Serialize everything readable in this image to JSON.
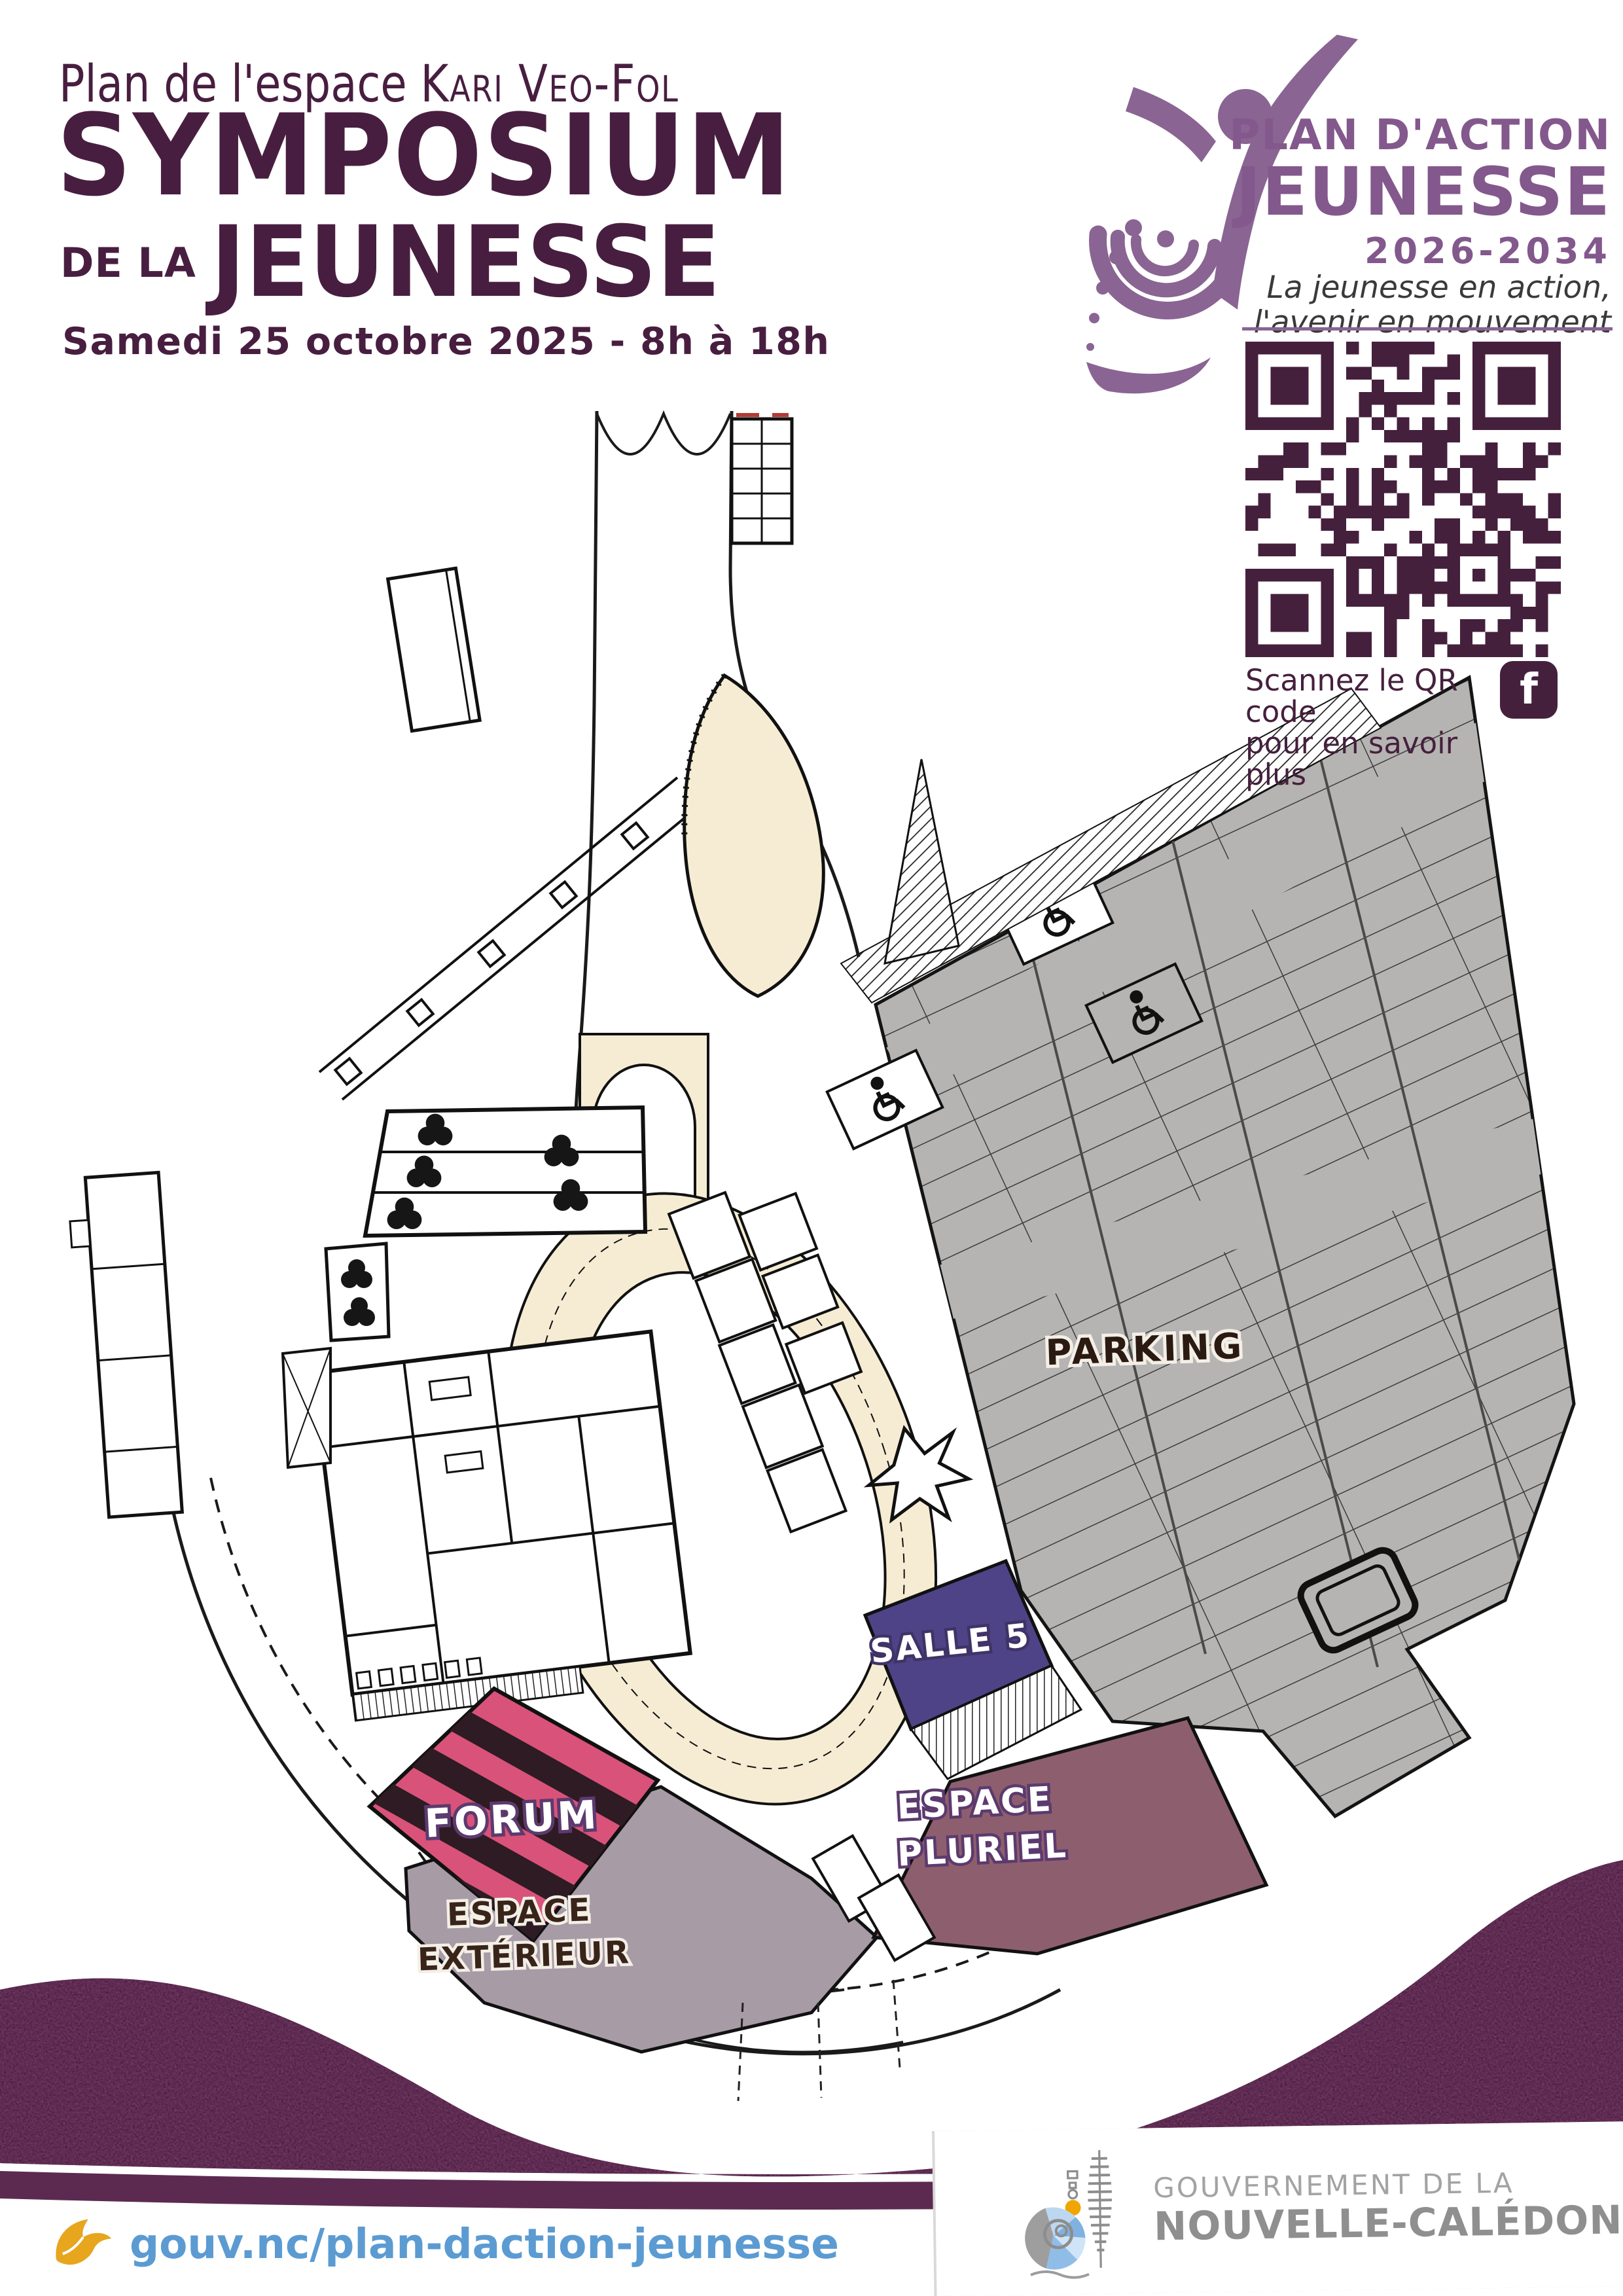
{
  "poster": {
    "header": {
      "subtitle_prefix": "Plan de l'espace ",
      "subtitle_name": "Kari Veo-Fol",
      "title": "SYMPOSIUM",
      "title_small": "DE LA",
      "title_big": "JEUNESSE",
      "date": "Samedi 25 octobre 2025 - 8h à 18h"
    },
    "logo": {
      "line1": "PLAN D'ACTION",
      "line2": "JEUNESSE",
      "years": "2026-2034",
      "tagline1": "La jeunesse en action,",
      "tagline2": "l'avenir en mouvement"
    },
    "qr": {
      "caption1": "Scannez le QR code",
      "caption2": "pour en savoir plus",
      "facebook_letter": "f"
    },
    "map": {
      "labels": {
        "parking": "PARKING",
        "salle5": "SALLE 5",
        "pluriel1": "ESPACE",
        "pluriel2": "PLURIEL",
        "forum": "FORUM",
        "exterieur1": "ESPACE",
        "exterieur2": "EXTÉRIEUR"
      }
    },
    "footer": {
      "url": "gouv.nc/plan-daction-jeunesse",
      "gov1": "GOUVERNEMENT DE LA",
      "gov2": "NOUVELLE-CALÉDONIE"
    },
    "colors": {
      "plum": "#481e40",
      "logo_purple": "#8a6492",
      "qr_plum": "#45203d",
      "wave": "#5c2a50",
      "link_blue": "#5b9bd2",
      "accent_yellow": "#e7a61e",
      "parking_gray": "#b6b4b2",
      "salle5_indigo": "#4f4387",
      "pluriel_mauve": "#8d5f6e",
      "forum_pink": "#d9527a",
      "exterieur_gray": "#a79ba6",
      "cream": "#f5ecd3"
    }
  }
}
